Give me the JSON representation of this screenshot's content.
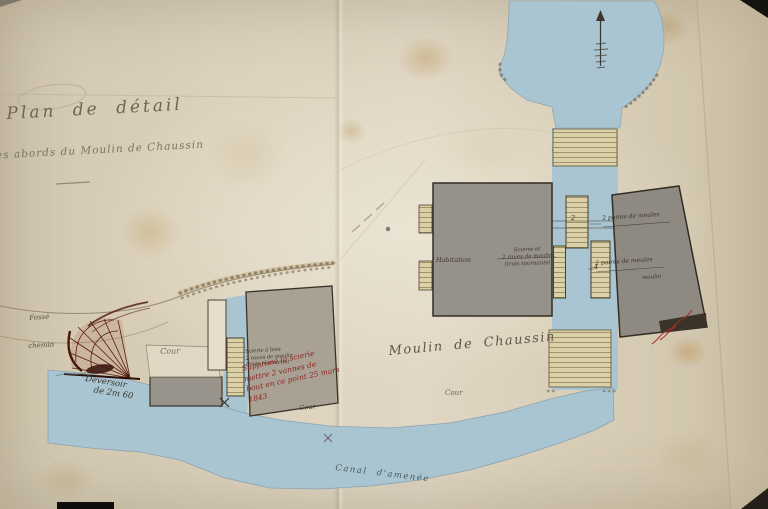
{
  "title": {
    "line1": "Plan de détail",
    "line2": "des abords du Moulin de Chaussin"
  },
  "site": {
    "main_label": "Moulin de Chaussin",
    "cour_center": "Cour",
    "cour_left_complex": "Cour",
    "cour_below_note": "Cour",
    "habitation": "Habitation",
    "machine_note": {
      "line1": "Scierie et",
      "line2": "2 roues de moulin",
      "line3": "(trois tournants)"
    },
    "left_machine_note": {
      "line1": "Scierie à bois",
      "line2": "2 roues de moulin",
      "line3": "(trois tournants)"
    },
    "right_building": {
      "label_top": "2 paires de meules",
      "label_mid": "2 paires de meules",
      "label_bottom": "moulin"
    },
    "wheel_marks": {
      "m1": "2",
      "m2": "4"
    },
    "fosse": "Fossé",
    "chemin": "chemin",
    "deversoir": {
      "line1": "Déversoir",
      "line2": "de 2m 60"
    },
    "canal": "Canal d'amenée"
  },
  "red_note": {
    "line1": "Supprimé la scierie",
    "line2": "mettre 2 vannes de",
    "line3": "bout en ce point 25 mars 1843"
  },
  "colors": {
    "paper": "#d8ceb9",
    "water": "#a9c5d2",
    "building_gray": "#948f88",
    "timber_hatch": "#dbd1a9",
    "ink": "#4a4236",
    "red_ink": "#8e2621",
    "maroon_weir": "#5a1d12"
  }
}
